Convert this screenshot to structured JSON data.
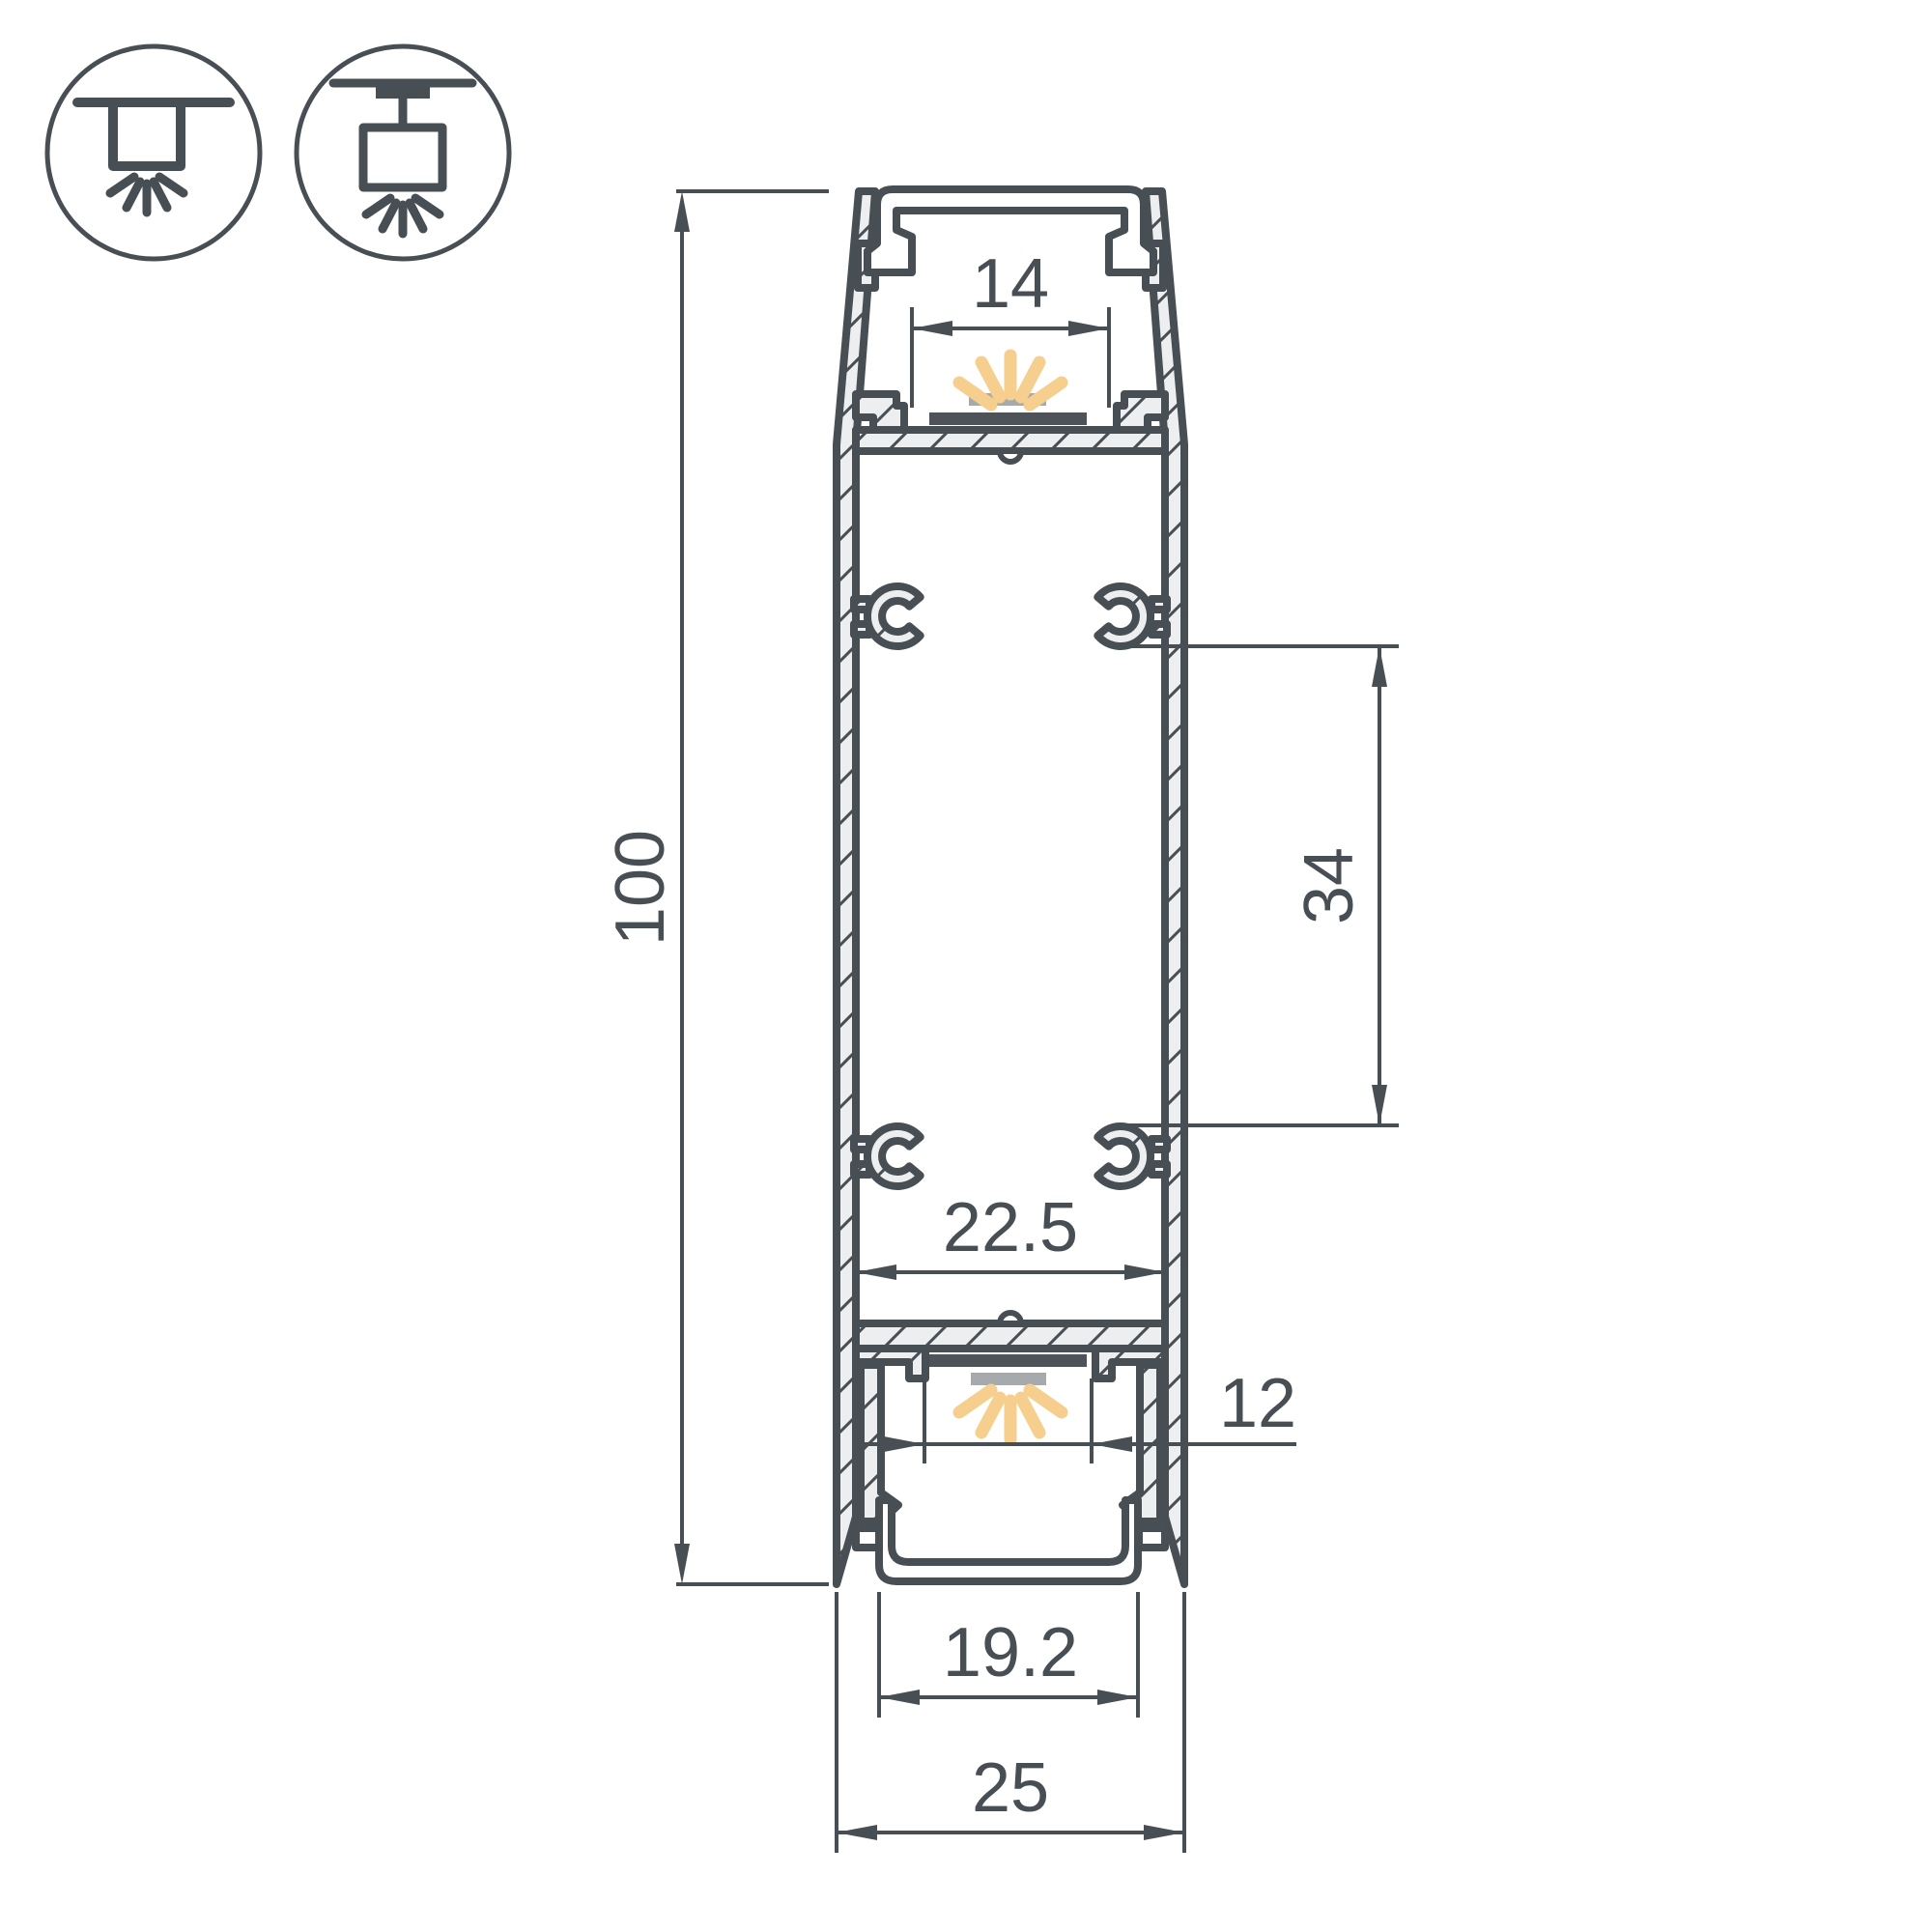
{
  "title": "LED aluminium profile cross-section drawing",
  "icons": {
    "surface_mount": "surface-ceiling-mount-icon",
    "pendant_mount": "pendant-suspension-mount-icon"
  },
  "dimensions": {
    "overall_height": "100",
    "top_opening_width": "14",
    "boss_spacing": "34",
    "inner_cavity_width": "22.5",
    "bottom_opening_width": "12",
    "diffuser_width": "19.2",
    "overall_width": "25"
  },
  "colors": {
    "line": "#474e54",
    "material_fill": "#eceef0",
    "led_glow": "#f6cf8e",
    "led_strip": "#a7aaac",
    "pcb": "#4d5358",
    "background": "#ffffff"
  }
}
